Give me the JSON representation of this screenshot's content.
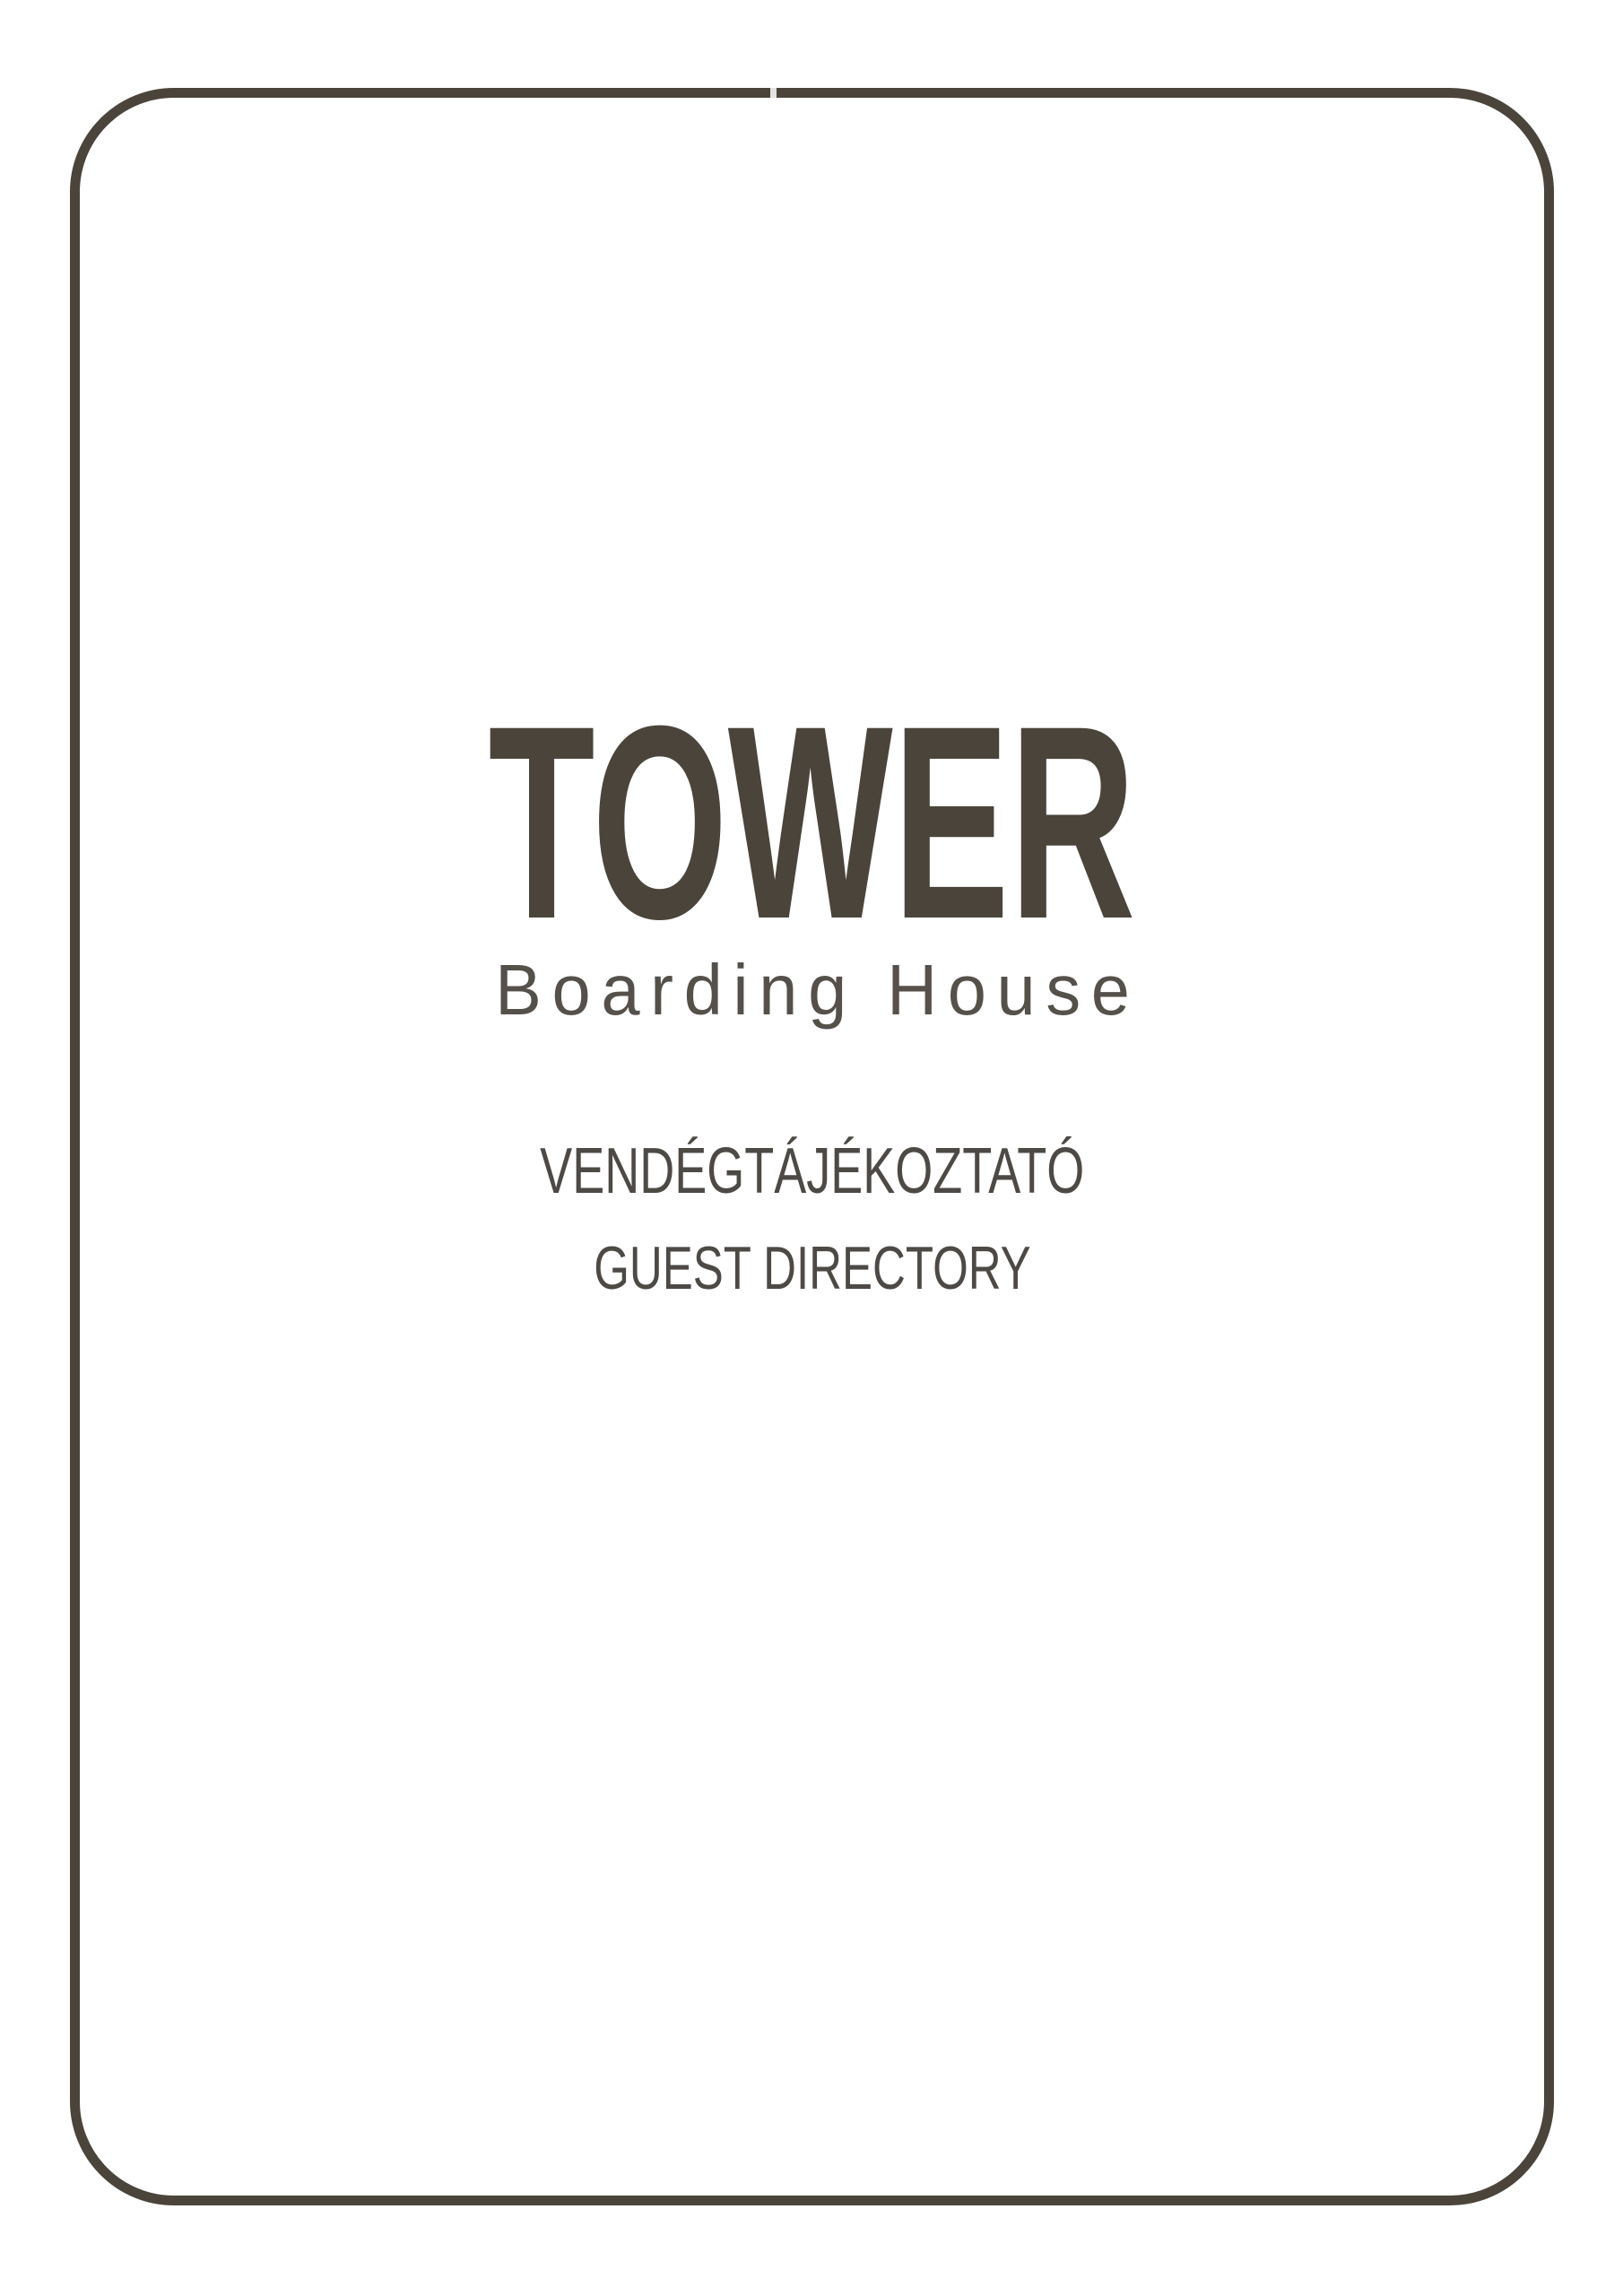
{
  "cover": {
    "logo": {
      "title": "TOWER",
      "subtitle": "Boarding House"
    },
    "directory_title_hu": "VENDÉGTÁJÉKOZTATÓ",
    "directory_title_en": "GUEST DIRECTORY"
  },
  "colors": {
    "frame": "#4a443a",
    "logo": "#4a443a",
    "subtitle": "#55504a",
    "directory": "#4d4945",
    "page-bg": "#ffffff"
  }
}
